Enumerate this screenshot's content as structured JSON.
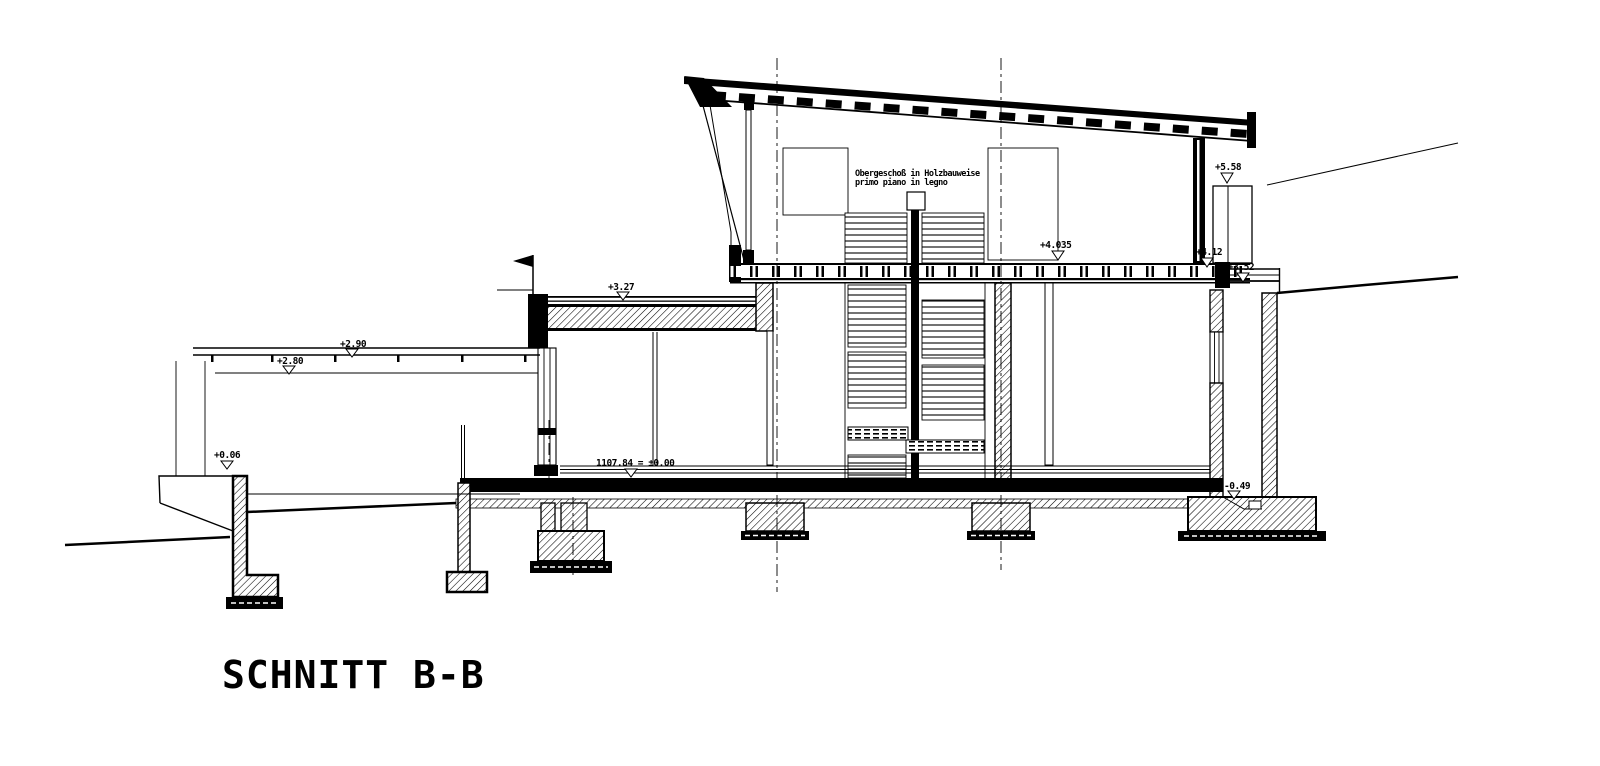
{
  "drawing": {
    "title": "SCHNITT B-B",
    "type": "architectural-section",
    "ink_color": "#000000",
    "paper_color": "#ffffff"
  },
  "annotation": {
    "line1": "Obergeschoß in Holzbauweise",
    "line2": "primo piano in legno"
  },
  "levels": {
    "l558": "+5.58",
    "l412": "+4.12",
    "l4035": "+4.035",
    "l352": "+3.52",
    "l327": "+3.27",
    "l290": "+2.90",
    "l280": "+2.80",
    "l006": "+0.06",
    "l000": "1107.84 = ±0.00",
    "lm049": "-0.49"
  }
}
